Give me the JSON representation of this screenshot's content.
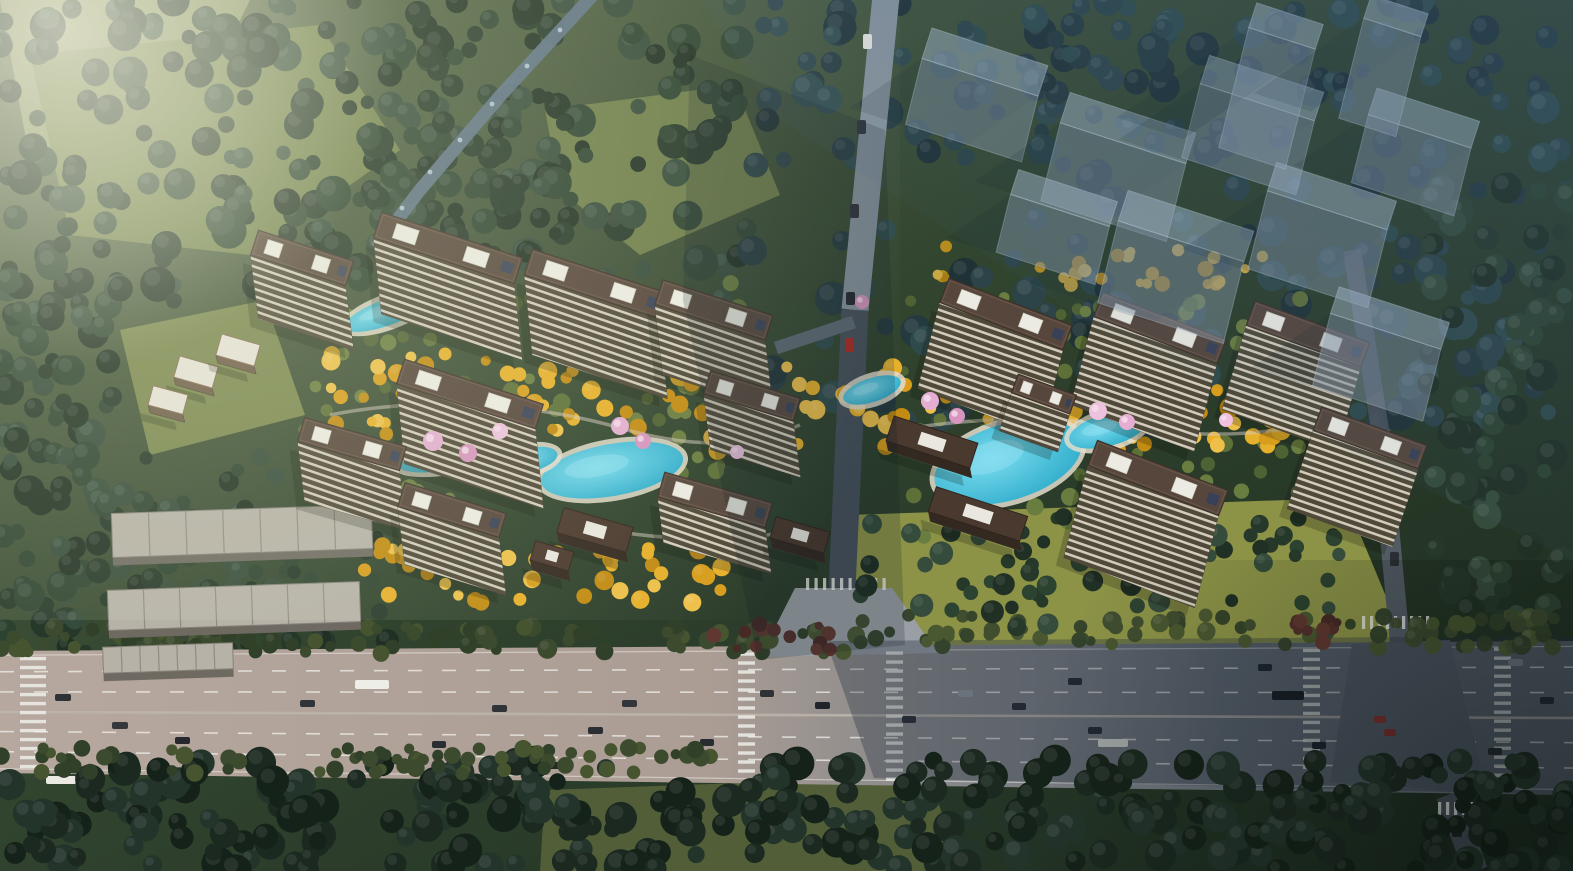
{
  "image": {
    "kind": "aerial-architectural-rendering",
    "width": 1573,
    "height": 871
  },
  "palette": {
    "forest_dark": [
      "#26382a",
      "#2d4331",
      "#203024",
      "#354b3b"
    ],
    "forest_blue": [
      "#253a3e",
      "#2c4448",
      "#203236",
      "#2f4a4b"
    ],
    "courtyard_green": [
      "#4f6233",
      "#5d7038",
      "#6a7d40"
    ],
    "gold_foliage": [
      "#d89d1c",
      "#e7b02a",
      "#c28b12",
      "#eec04a"
    ],
    "street_olive": [
      "#3c4a2e",
      "#46552f",
      "#314029"
    ],
    "bottom_dark": [
      "#1b2920",
      "#152219",
      "#23342b"
    ],
    "maroon_shrub": [
      "#54302b",
      "#613831",
      "#472a26"
    ],
    "blossom_pink": [
      "#e4aed2",
      "#d795bf",
      "#eec2de"
    ],
    "pool_water": "#2aa9c9",
    "pool_light": "#7adcee",
    "pool_deck": "#e3ddcc",
    "roof_brown": "#56463c",
    "roof_edge": "#3b2f28",
    "penthouse_white": "#ecebe3",
    "solar_panel": "#33415c",
    "facade_dark": "#574f3e",
    "facade_stripe": "#e8e2d2",
    "lowrise_roof": "#b6b2a8",
    "lowrise_seam": "#908c83",
    "pavilion_roof": "#4a392e",
    "villa_roof": "#e7e3d8",
    "highway_sunlit": "#b7a89f",
    "highway_shadow": "#5d646d",
    "road_north_top": "#87939d",
    "road_north_shadow": "#47505a",
    "road_east": "#525a64",
    "canal_blue": "#5e7388",
    "ghost_building": "rgba(170,190,206,0.5)",
    "marking_white": "#f2f2ee",
    "red_sign": "#b02a22"
  },
  "scene": {
    "meadows": [
      {
        "pts": [
          [
            0,
            0
          ],
          [
            250,
            0
          ],
          [
            190,
            120
          ],
          [
            30,
            160
          ]
        ],
        "c": "#8d986a",
        "op": 0.9
      },
      {
        "pts": [
          [
            30,
            55
          ],
          [
            320,
            25
          ],
          [
            400,
            150
          ],
          [
            250,
            255
          ],
          [
            70,
            235
          ]
        ],
        "c": "#73824e",
        "op": 1
      },
      {
        "pts": [
          [
            545,
            110
          ],
          [
            735,
            85
          ],
          [
            780,
            195
          ],
          [
            640,
            255
          ],
          [
            560,
            190
          ]
        ],
        "c": "#6e7d4a",
        "op": 1
      },
      {
        "pts": [
          [
            120,
            330
          ],
          [
            265,
            300
          ],
          [
            305,
            415
          ],
          [
            150,
            455
          ]
        ],
        "c": "#7a8750",
        "op": 1
      },
      {
        "pts": [
          [
            848,
            515
          ],
          [
            1345,
            498
          ],
          [
            1405,
            642
          ],
          [
            858,
            648
          ]
        ],
        "c": "#8c9347",
        "op": 1
      },
      {
        "pts": [
          [
            545,
            790
          ],
          [
            930,
            776
          ],
          [
            960,
            871
          ],
          [
            540,
            871
          ]
        ],
        "c": "#525e38",
        "op": 1
      }
    ],
    "forests_back": [
      {
        "x": 0,
        "y": 0,
        "w": 750,
        "h": 305,
        "n": 230,
        "r0": 7,
        "r1": 18,
        "pal": "forest_dark",
        "seed": 11
      },
      {
        "x": 0,
        "y": 280,
        "w": 125,
        "h": 430,
        "n": 85,
        "r0": 7,
        "r1": 16,
        "pal": "forest_dark",
        "seed": 12
      },
      {
        "x": 745,
        "y": 0,
        "w": 828,
        "h": 430,
        "n": 250,
        "r0": 7,
        "r1": 17,
        "pal": "forest_blue",
        "seed": 13
      },
      {
        "x": 1428,
        "y": 185,
        "w": 145,
        "h": 560,
        "n": 95,
        "r0": 7,
        "r1": 16,
        "pal": "forest_dark",
        "seed": 14
      },
      {
        "x": 355,
        "y": 55,
        "w": 240,
        "h": 200,
        "n": 45,
        "r0": 6,
        "r1": 13,
        "pal": "forest_dark",
        "seed": 15
      },
      {
        "x": 60,
        "y": 448,
        "w": 330,
        "h": 215,
        "n": 95,
        "r0": 6,
        "r1": 12,
        "pal": "forest_dark",
        "seed": 28
      }
    ],
    "forests_front": [
      {
        "x": 0,
        "y": 760,
        "w": 1573,
        "h": 111,
        "n": 300,
        "r0": 8,
        "r1": 17,
        "pal": "bottom_dark",
        "seed": 16
      },
      {
        "x": 0,
        "y": 626,
        "w": 845,
        "h": 28,
        "n": 95,
        "r0": 5,
        "r1": 10,
        "pal": "street_olive",
        "seed": 17
      },
      {
        "x": 845,
        "y": 614,
        "w": 728,
        "h": 34,
        "n": 80,
        "r0": 5,
        "r1": 10,
        "pal": "street_olive",
        "seed": 18,
        "op": 0.95
      },
      {
        "x": 0,
        "y": 748,
        "w": 720,
        "h": 26,
        "n": 70,
        "r0": 5,
        "r1": 9,
        "pal": "street_olive",
        "seed": 19
      },
      {
        "x": 295,
        "y": 275,
        "w": 470,
        "h": 255,
        "n": 80,
        "r0": 5,
        "r1": 9,
        "pal": "courtyard_green",
        "seed": 20
      },
      {
        "x": 895,
        "y": 295,
        "w": 445,
        "h": 245,
        "n": 70,
        "r0": 5,
        "r1": 9,
        "pal": "courtyard_green",
        "seed": 21
      },
      {
        "x": 330,
        "y": 350,
        "w": 390,
        "h": 88,
        "n": 62,
        "r0": 5,
        "r1": 10,
        "pal": "gold_foliage",
        "seed": 22
      },
      {
        "x": 688,
        "y": 366,
        "w": 344,
        "h": 86,
        "n": 56,
        "r0": 5,
        "r1": 10,
        "pal": "gold_foliage",
        "seed": 23
      },
      {
        "x": 1038,
        "y": 380,
        "w": 245,
        "h": 72,
        "n": 42,
        "r0": 5,
        "r1": 10,
        "pal": "gold_foliage",
        "seed": 24
      },
      {
        "x": 360,
        "y": 543,
        "w": 375,
        "h": 64,
        "n": 48,
        "r0": 5,
        "r1": 10,
        "pal": "gold_foliage",
        "seed": 25
      },
      {
        "x": 930,
        "y": 243,
        "w": 335,
        "h": 48,
        "n": 26,
        "r0": 4,
        "r1": 8,
        "pal": "gold_foliage",
        "seed": 26,
        "op": 0.8
      },
      {
        "x": 855,
        "y": 515,
        "w": 500,
        "h": 125,
        "n": 75,
        "r0": 6,
        "r1": 12,
        "pal": "forest_dark",
        "seed": 27
      },
      {
        "x": 1280,
        "y": 620,
        "w": 70,
        "h": 30,
        "n": 12,
        "r0": 4,
        "r1": 8,
        "pal": "maroon_shrub",
        "seed": 29
      },
      {
        "x": 690,
        "y": 624,
        "w": 150,
        "h": 26,
        "n": 14,
        "r0": 4,
        "r1": 8,
        "pal": "maroon_shrub",
        "seed": 30
      }
    ],
    "canal": {
      "line": [
        [
          594,
          -6
        ],
        [
          500,
          96
        ],
        [
          420,
          190
        ],
        [
          376,
          248
        ]
      ],
      "width": 13,
      "glints": [
        [
          560,
          30
        ],
        [
          527,
          66
        ],
        [
          492,
          104
        ],
        [
          460,
          140
        ],
        [
          430,
          172
        ],
        [
          402,
          208
        ]
      ]
    },
    "roads": {
      "highway": {
        "band": [
          [
            0,
            651
          ],
          [
            1573,
            641
          ],
          [
            1573,
            795
          ],
          [
            0,
            773
          ]
        ],
        "lane_fracs": [
          0.17,
          0.335,
          0.66,
          0.825
        ],
        "edge_fracs": [
          0.035,
          0.965
        ],
        "median_frac": 0.5,
        "crosswalks": [
          [
            20,
            26
          ],
          [
            738,
            17
          ],
          [
            886,
            17
          ],
          [
            1303,
            17
          ],
          [
            1494,
            17
          ]
        ],
        "shade": [
          [
            826,
            641
          ],
          [
            1573,
            636
          ],
          [
            1573,
            795
          ],
          [
            874,
            778
          ]
        ]
      },
      "north": {
        "seg_top": [
          [
            886,
            -4
          ],
          [
            855,
            310
          ]
        ],
        "seg_bot": [
          [
            855,
            310
          ],
          [
            842,
            588
          ]
        ],
        "spur": [
          [
            854,
            322
          ],
          [
            776,
            348
          ]
        ],
        "flare": [
          [
            795,
            588
          ],
          [
            892,
            588
          ],
          [
            938,
            653
          ],
          [
            760,
            657
          ]
        ],
        "crosswalk": {
          "x0": 806,
          "x1": 888,
          "y": 578,
          "step": 8.5
        }
      },
      "east": {
        "seg_top": [
          [
            1352,
            250
          ],
          [
            1380,
            430
          ]
        ],
        "seg_bot": [
          [
            1380,
            430
          ],
          [
            1400,
            644
          ]
        ],
        "flare": [
          [
            1352,
            644
          ],
          [
            1450,
            640
          ],
          [
            1488,
            794
          ],
          [
            1330,
            782
          ]
        ],
        "south": [
          [
            1448,
            795
          ],
          [
            1476,
            871
          ]
        ],
        "crosswalk": {
          "x0": 1362,
          "x1": 1430,
          "y": 616,
          "step": 8
        },
        "crosswalk2": {
          "x0": 1438,
          "x1": 1482,
          "y": 802,
          "step": 8
        }
      }
    },
    "vehicles_highway": [
      [
        55,
        694,
        16,
        7,
        "#2e3136"
      ],
      [
        112,
        722,
        16,
        7,
        "#34373c"
      ],
      [
        178,
        671,
        15,
        7,
        "#2c2f34"
      ],
      [
        175,
        737,
        15,
        7,
        "#26282d"
      ],
      [
        248,
        755,
        14,
        7,
        "#2c2f34"
      ],
      [
        355,
        680,
        34,
        9,
        "#eeeee9"
      ],
      [
        46,
        776,
        30,
        8,
        "#ebe9e2"
      ],
      [
        300,
        700,
        15,
        7,
        "#303338"
      ],
      [
        382,
        757,
        14,
        7,
        "#212429"
      ],
      [
        432,
        741,
        14,
        7,
        "#2a2d32"
      ],
      [
        492,
        705,
        15,
        7,
        "#303338"
      ],
      [
        548,
        762,
        14,
        7,
        "#24272c"
      ],
      [
        588,
        727,
        15,
        7,
        "#2b2e33"
      ],
      [
        622,
        700,
        15,
        7,
        "#33363b"
      ],
      [
        700,
        739,
        14,
        7,
        "#282b30"
      ],
      [
        760,
        690,
        14,
        7,
        "#2e3136"
      ],
      [
        815,
        702,
        15,
        7,
        "#20252c"
      ],
      [
        902,
        716,
        14,
        7,
        "#262b31"
      ],
      [
        958,
        690,
        15,
        7,
        "#8f959b"
      ],
      [
        1012,
        703,
        14,
        7,
        "#22272d"
      ],
      [
        1068,
        678,
        14,
        7,
        "#1f242a"
      ],
      [
        1088,
        727,
        14,
        7,
        "#20252b"
      ],
      [
        1098,
        739,
        30,
        8,
        "#dedfda"
      ],
      [
        1272,
        691,
        32,
        9,
        "#111419"
      ],
      [
        1258,
        664,
        14,
        7,
        "#1b2026"
      ],
      [
        1312,
        742,
        14,
        7,
        "#171c22"
      ],
      [
        1374,
        716,
        12,
        7,
        "#a32d26"
      ],
      [
        1384,
        729,
        12,
        7,
        "#992a24"
      ],
      [
        1508,
        659,
        15,
        7,
        "#878d93"
      ],
      [
        1540,
        697,
        14,
        7,
        "#1e242a"
      ],
      [
        1488,
        748,
        14,
        7,
        "#20262c"
      ]
    ],
    "vehicles_vertical": [
      [
        863,
        34,
        9,
        15,
        "#e8e8e2"
      ],
      [
        857,
        120,
        9,
        14,
        "#2c3036"
      ],
      [
        850,
        204,
        9,
        14,
        "#30343a"
      ],
      [
        846,
        292,
        9,
        13,
        "#23272d"
      ],
      [
        1377,
        452,
        9,
        14,
        "#23282e"
      ],
      [
        1390,
        552,
        9,
        14,
        "#2a2f35"
      ],
      [
        1452,
        822,
        10,
        15,
        "#1e2329"
      ]
    ],
    "pools": [
      [
        455,
        448,
        62,
        20,
        -14
      ],
      [
        612,
        470,
        72,
        26,
        -10
      ],
      [
        528,
        460,
        30,
        12,
        -12
      ],
      [
        388,
        312,
        46,
        13,
        -20
      ],
      [
        872,
        390,
        30,
        12,
        -18
      ],
      [
        1008,
        462,
        76,
        38,
        -17
      ],
      [
        1108,
        430,
        40,
        16,
        -15
      ]
    ],
    "paths": [
      "M 330,415 C 430,395 540,405 620,428 S 750,445 800,425",
      "M 890,432 C 960,418 1050,415 1115,425 S 1230,438 1290,428",
      "M 560,520 C 640,540 720,545 800,530"
    ],
    "buildings": {
      "towers": [
        [
          302,
          258,
          100,
          26,
          18,
          64,
          8
        ],
        [
          448,
          248,
          148,
          27,
          18,
          76,
          8
        ],
        [
          596,
          284,
          142,
          27,
          18,
          80,
          8
        ],
        [
          714,
          310,
          116,
          26,
          18,
          70,
          8
        ],
        [
          752,
          396,
          94,
          24,
          17,
          56,
          7
        ],
        [
          470,
          394,
          146,
          26,
          18,
          80,
          8
        ],
        [
          352,
          444,
          106,
          25,
          16,
          60,
          7
        ],
        [
          452,
          510,
          106,
          25,
          17,
          58,
          7
        ],
        [
          715,
          500,
          112,
          26,
          16,
          46,
          6
        ],
        [
          1006,
          314,
          132,
          26,
          21,
          86,
          -22
        ],
        [
          1160,
          328,
          132,
          26,
          21,
          88,
          -23
        ],
        [
          1308,
          334,
          122,
          26,
          20,
          84,
          -24
        ],
        [
          1370,
          438,
          112,
          25,
          20,
          78,
          -26
        ],
        [
          1158,
          478,
          140,
          27,
          21,
          92,
          -24
        ],
        [
          1044,
          394,
          62,
          20,
          20,
          38,
          -12
        ]
      ],
      "rows": [
        [
          242,
          531,
          260,
          44,
          -2
        ],
        [
          234,
          606,
          252,
          40,
          -2
        ],
        [
          168,
          658,
          130,
          26,
          -2
        ]
      ],
      "villas": [
        [
          196,
          372,
          40,
          22,
          16
        ],
        [
          238,
          350,
          40,
          22,
          16
        ],
        [
          168,
          400,
          36,
          20,
          15
        ]
      ],
      "pavilions": [
        [
          595,
          530,
          72,
          26,
          16
        ],
        [
          552,
          556,
          40,
          20,
          16
        ],
        [
          932,
          442,
          88,
          26,
          18
        ],
        [
          978,
          514,
          96,
          26,
          18
        ],
        [
          800,
          535,
          56,
          22,
          16
        ]
      ]
    },
    "ghosts": [
      [
        985,
        62,
        122,
        32,
        18,
        66
      ],
      [
        1128,
        128,
        132,
        32,
        18,
        78
      ],
      [
        1262,
        88,
        120,
        30,
        18,
        74
      ],
      [
        1186,
        226,
        132,
        32,
        18,
        82
      ],
      [
        1332,
        196,
        126,
        30,
        18,
        78
      ],
      [
        1424,
        118,
        108,
        28,
        18,
        68
      ],
      [
        1064,
        198,
        104,
        26,
        18,
        58
      ],
      [
        1390,
        318,
        116,
        28,
        18,
        72
      ],
      [
        1286,
        26,
        70,
        26,
        18,
        120
      ],
      [
        1396,
        16,
        60,
        24,
        18,
        100
      ]
    ],
    "ghost_shadow_band": [
      [
        690,
        55
      ],
      [
        885,
        130
      ],
      [
        905,
        645
      ],
      [
        758,
        660
      ],
      [
        683,
        300
      ]
    ],
    "blossoms": [
      [
        433,
        441,
        10
      ],
      [
        468,
        453,
        9
      ],
      [
        500,
        431,
        8
      ],
      [
        620,
        426,
        9
      ],
      [
        643,
        441,
        8
      ],
      [
        737,
        452,
        7
      ],
      [
        930,
        401,
        9
      ],
      [
        957,
        416,
        8
      ],
      [
        1098,
        411,
        9
      ],
      [
        1127,
        422,
        8
      ],
      [
        862,
        302,
        7
      ],
      [
        1226,
        420,
        7
      ]
    ],
    "markers": [
      {
        "x": 846,
        "y": 338,
        "w": 7,
        "h": 14,
        "c": "#b02a22",
        "name": "red-gate-sign"
      }
    ]
  }
}
